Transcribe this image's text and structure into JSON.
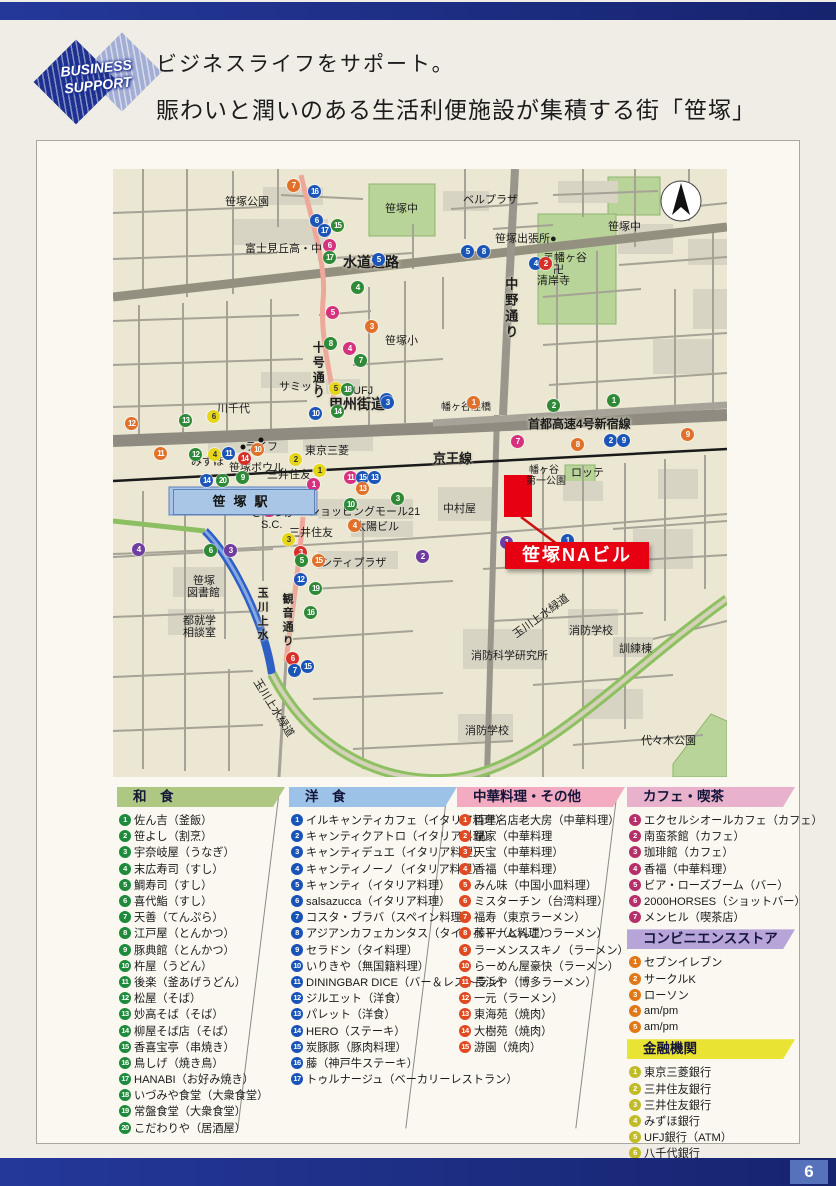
{
  "page": {
    "number": "6"
  },
  "header": {
    "logo_line1": "BUSINESS",
    "logo_line2": "SUPPORT",
    "title_line1": "ビジネスライフをサポート。",
    "title_line2": "賑わいと潤いのある生活利便施設が集積する街「笹塚」"
  },
  "map": {
    "station": "笹塚駅",
    "na_label": "笹塚NAビル",
    "marker_colors": {
      "g": "#2f8a38",
      "b": "#1c55b8",
      "o": "#e0702a",
      "m": "#d6317e",
      "p": "#6f3da0",
      "y": "#e5d619",
      "r": "#d63028"
    },
    "labels": [
      {
        "t": "笹塚公園",
        "x": 112,
        "y": 27
      },
      {
        "t": "笹塚中",
        "x": 272,
        "y": 34
      },
      {
        "t": "ベルプラザ",
        "x": 350,
        "y": 25
      },
      {
        "t": "笹塚中",
        "x": 495,
        "y": 52
      },
      {
        "t": "笹塚出張所●",
        "x": 382,
        "y": 64
      },
      {
        "t": "富士見丘高・中",
        "x": 132,
        "y": 74
      },
      {
        "t": "〒幡ヶ谷",
        "x": 430,
        "y": 83
      },
      {
        "t": "卍",
        "x": 440,
        "y": 95
      },
      {
        "t": "清岸寺",
        "x": 424,
        "y": 106
      },
      {
        "t": "水道道路",
        "x": 230,
        "y": 86,
        "b": 1,
        "s": 14
      },
      {
        "t": "中野通り",
        "x": 390,
        "y": 108,
        "v": 1,
        "s": 13
      },
      {
        "t": "笹塚小",
        "x": 272,
        "y": 166
      },
      {
        "t": "十号通り",
        "x": 198,
        "y": 172,
        "v": 1,
        "s": 12
      },
      {
        "t": "サミット",
        "x": 166,
        "y": 212
      },
      {
        "t": "UFJ",
        "x": 240,
        "y": 216
      },
      {
        "t": "川千代",
        "x": 104,
        "y": 234
      },
      {
        "t": "甲州街道",
        "x": 216,
        "y": 228,
        "b": 1,
        "s": 14
      },
      {
        "t": "幡ヶ谷陸橋",
        "x": 328,
        "y": 233,
        "s": 10
      },
      {
        "t": "首都高速4号新宿線",
        "x": 415,
        "y": 249,
        "b": 1,
        "s": 12
      },
      {
        "t": "東京三菱",
        "x": 192,
        "y": 276
      },
      {
        "t": "ライフ",
        "x": 132,
        "y": 272
      },
      {
        "t": "みずほ",
        "x": 78,
        "y": 287
      },
      {
        "t": "笹塚ボウル",
        "x": 116,
        "y": 293
      },
      {
        "t": "三井住友",
        "x": 154,
        "y": 300
      },
      {
        "t": "京王線",
        "x": 320,
        "y": 283,
        "b": 1,
        "s": 13
      },
      {
        "t": "幡ヶ谷",
        "x": 416,
        "y": 296,
        "s": 10
      },
      {
        "t": "第一公園",
        "x": 413,
        "y": 307,
        "s": 10
      },
      {
        "t": "ロッテ",
        "x": 458,
        "y": 298
      },
      {
        "t": "中村屋",
        "x": 330,
        "y": 334
      },
      {
        "t": "ささづか",
        "x": 138,
        "y": 338
      },
      {
        "t": "S.C.",
        "x": 148,
        "y": 350
      },
      {
        "t": "ショッピングモール21",
        "x": 196,
        "y": 337
      },
      {
        "t": "太陽ビル",
        "x": 242,
        "y": 352
      },
      {
        "t": "三井住友",
        "x": 176,
        "y": 358
      },
      {
        "t": "シティプラザ",
        "x": 208,
        "y": 388
      },
      {
        "t": "笹塚",
        "x": 80,
        "y": 406
      },
      {
        "t": "図書館",
        "x": 74,
        "y": 418
      },
      {
        "t": "玉川上水",
        "x": 143,
        "y": 418,
        "v": 1
      },
      {
        "t": "観音通り",
        "x": 168,
        "y": 424,
        "v": 1
      },
      {
        "t": "都就学",
        "x": 70,
        "y": 446
      },
      {
        "t": "相談室",
        "x": 70,
        "y": 458
      },
      {
        "t": "消防学校",
        "x": 456,
        "y": 456
      },
      {
        "t": "訓練棟",
        "x": 506,
        "y": 474
      },
      {
        "t": "消防科学研究所",
        "x": 358,
        "y": 481
      },
      {
        "t": "玉川上水緑道",
        "x": 398,
        "y": 462,
        "r": -36
      },
      {
        "t": "玉川上水緑道",
        "x": 148,
        "y": 508,
        "r": 58
      },
      {
        "t": "消防学校",
        "x": 352,
        "y": 556
      },
      {
        "t": "代々木公園",
        "x": 528,
        "y": 566
      }
    ],
    "markers": [
      [
        "7",
        "o",
        174,
        10
      ],
      [
        "16",
        "b",
        195,
        16
      ],
      [
        "6",
        "b",
        197,
        45
      ],
      [
        "15",
        "g",
        218,
        50
      ],
      [
        "17",
        "b",
        205,
        55
      ],
      [
        "6",
        "m",
        210,
        70
      ],
      [
        "17",
        "g",
        210,
        82
      ],
      [
        "5",
        "b",
        259,
        84
      ],
      [
        "4",
        "g",
        238,
        112
      ],
      [
        "5",
        "m",
        213,
        137
      ],
      [
        "3",
        "o",
        252,
        151
      ],
      [
        "8",
        "g",
        211,
        168
      ],
      [
        "4",
        "m",
        230,
        173
      ],
      [
        "7",
        "g",
        241,
        185
      ],
      [
        "5",
        "y",
        216,
        213
      ],
      [
        "18",
        "g",
        228,
        214
      ],
      [
        "3",
        "b",
        267,
        224
      ],
      [
        "5",
        "b",
        348,
        76
      ],
      [
        "8",
        "b",
        364,
        76
      ],
      [
        "4",
        "b",
        416,
        88
      ],
      [
        "2",
        "r",
        426,
        88
      ],
      [
        "12",
        "o",
        12,
        248
      ],
      [
        "13",
        "g",
        66,
        245
      ],
      [
        "6",
        "y",
        94,
        241
      ],
      [
        "10",
        "b",
        196,
        238
      ],
      [
        "14",
        "g",
        218,
        236
      ],
      [
        "3",
        "b",
        268,
        227
      ],
      [
        "11",
        "o",
        41,
        278
      ],
      [
        "12",
        "g",
        76,
        279
      ],
      [
        "4",
        "y",
        95,
        279
      ],
      [
        "11",
        "b",
        109,
        278
      ],
      [
        "14",
        "r",
        125,
        283
      ],
      [
        "10",
        "o",
        138,
        274
      ],
      [
        "2",
        "y",
        176,
        284
      ],
      [
        "1",
        "y",
        200,
        295
      ],
      [
        "14",
        "b",
        87,
        305
      ],
      [
        "20",
        "g",
        103,
        305
      ],
      [
        "9",
        "g",
        123,
        302
      ],
      [
        "11",
        "m",
        231,
        302
      ],
      [
        "15",
        "b",
        243,
        302
      ],
      [
        "13",
        "b",
        255,
        302
      ],
      [
        "1",
        "m",
        194,
        309
      ],
      [
        "13",
        "o",
        243,
        313
      ],
      [
        "3",
        "g",
        278,
        323
      ],
      [
        "10",
        "g",
        231,
        329
      ],
      [
        "2",
        "m",
        150,
        335
      ],
      [
        "4",
        "o",
        235,
        350
      ],
      [
        "3",
        "y",
        169,
        364
      ],
      [
        "4",
        "p",
        19,
        374
      ],
      [
        "6",
        "g",
        91,
        375
      ],
      [
        "3",
        "p",
        111,
        375
      ],
      [
        "3",
        "r",
        181,
        377
      ],
      [
        "5",
        "g",
        182,
        385
      ],
      [
        "15",
        "o",
        199,
        385
      ],
      [
        "2",
        "p",
        303,
        381
      ],
      [
        "12",
        "b",
        181,
        404
      ],
      [
        "19",
        "g",
        196,
        413
      ],
      [
        "16",
        "g",
        191,
        437
      ],
      [
        "7",
        "m",
        398,
        266
      ],
      [
        "8",
        "o",
        458,
        269
      ],
      [
        "2",
        "b",
        491,
        265
      ],
      [
        "9",
        "b",
        504,
        265
      ],
      [
        "9",
        "o",
        568,
        259
      ],
      [
        "1",
        "p",
        387,
        367
      ],
      [
        "1",
        "b",
        448,
        365
      ],
      [
        "1",
        "o",
        354,
        227
      ],
      [
        "2",
        "g",
        434,
        230
      ],
      [
        "1",
        "g",
        494,
        225
      ],
      [
        "6",
        "r",
        173,
        483
      ],
      [
        "7",
        "b",
        175,
        495
      ],
      [
        "15",
        "b",
        188,
        491
      ]
    ]
  },
  "legend": {
    "columns": [
      {
        "title": "和　食",
        "band": "#aec883",
        "bullet": "#1d8a3c",
        "items": [
          "佐ん吉（釜飯）",
          "笹よし（割烹）",
          "宇奈岐屋（うなぎ）",
          "末広寿司（すし）",
          "鯛寿司（すし）",
          "喜代鮨（すし）",
          "天善（てんぷら）",
          "江戸屋（とんかつ）",
          "豚典館（とんかつ）",
          "杵屋（うどん）",
          "後楽（釜あげうどん）",
          "松屋（そば）",
          "妙高そば（そば）",
          "柳屋そば店（そば）",
          "香喜宝亭（串焼き）",
          "鳥しげ（焼き鳥）",
          "HANABI（お好み焼き）",
          "いづみや食堂（大衆食堂）",
          "常盤食堂（大衆食堂）",
          "こだわりや（居酒屋）"
        ]
      },
      {
        "title": "洋　食",
        "band": "#9cc2e8",
        "bullet": "#1a53b8",
        "items": [
          "イルキャンティカフェ（イタリア料理）",
          "キャンティクアトロ（イタリア料理）",
          "キャンティデュエ（イタリア料理）",
          "キャンティノーノ（イタリア料理）",
          "キャンティ（イタリア料理）",
          "salsazucca（イタリア料理）",
          "コスタ・ブラバ（スペイン料理）",
          "アジアンカフェカンタス（タイ、ベトナム料理）",
          "セラドン（タイ料理）",
          "いりきや（無国籍料理）",
          "DININGBAR DICE（バー＆レストラン）",
          "ジルエット（洋食）",
          "パレット（洋食）",
          "HERO（ステーキ）",
          "炭豚豚（豚肉料理）",
          "藤（神戸牛ステーキ）",
          "トゥルナージュ（ベーカリーレストラン）"
        ]
      },
      {
        "title": "中華料理・その他",
        "band": "#f2abc0",
        "bullet": "#e04a22",
        "items": [
          "百年名店老大房（中華料理）",
          "鍋家（中華料理",
          "天宝（中華料理）",
          "香福（中華料理）",
          "みん味（中国小皿料理）",
          "ミスターチン（台湾料理）",
          "福寿（東京ラーメン）",
          "藤平（とんこつラーメン）",
          "ラーメンススキノ（ラーメン）",
          "らーめん屋豪快（ラーメン）",
          "長浜や（博多ラーメン）",
          "一元（ラーメン）",
          "東海苑（焼肉）",
          "大樹苑（焼肉）",
          "游園（焼肉）"
        ]
      },
      {
        "title": "カフェ・喫茶",
        "band": "#e9b2cc",
        "bullet": "#b5306a",
        "items": [
          "エクセルシオールカフェ（カフェ）",
          "南蛮茶館（カフェ）",
          "珈琲館（カフェ）",
          "香福（中華料理）",
          "ビア・ローズブーム（バー）",
          "2000HORSES（ショットバー）",
          "メンヒル（喫茶店）"
        ],
        "sections": [
          {
            "title": "コンビニエンスストア",
            "band": "#b7a4d8",
            "bullet": "#e07818",
            "items": [
              "セブンイレブン",
              "サークルK",
              "ローソン",
              "am/pm",
              "am/pm"
            ]
          },
          {
            "title": "金融機関",
            "band": "#e9e433",
            "bullet": "#c2bb28",
            "items": [
              "東京三菱銀行",
              "三井住友銀行",
              "三井住友銀行",
              "みずほ銀行",
              "UFJ銀行（ATM）",
              "八千代銀行"
            ]
          }
        ]
      }
    ]
  }
}
